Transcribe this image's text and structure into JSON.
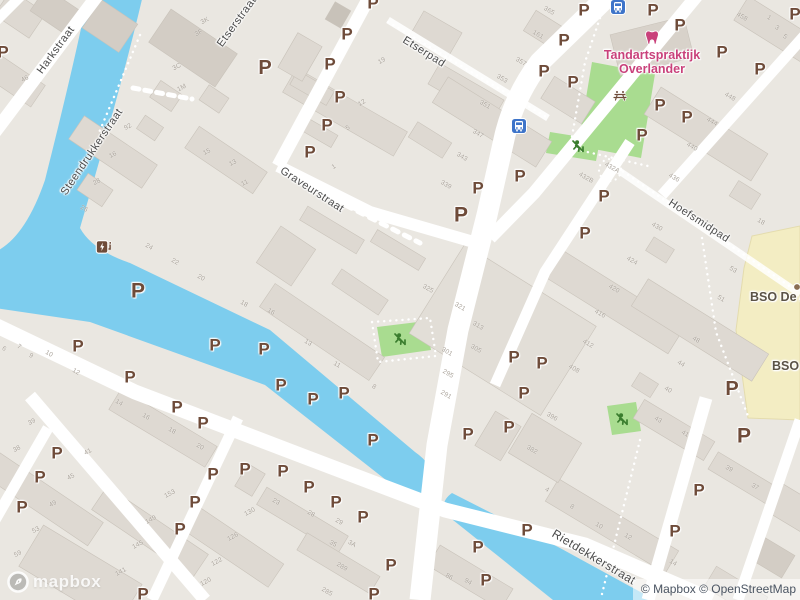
{
  "map": {
    "attribution": "© Mapbox © OpenStreetMap",
    "logo_text": "mapbox",
    "colors": {
      "land": "#eae7e1",
      "water": "#7dcdee",
      "park": "#a9dc90",
      "school_building": "#f3edc3",
      "parking_brown": "#6e4b39",
      "street_label_gray": "#4c4c4c",
      "poi_pink": "#c9417b",
      "poi_school_label": "#5b5346",
      "bus_blue": "#3e74c9",
      "playground_green": "#3a7d2e"
    },
    "street_labels": [
      {
        "text": "Harkstraat",
        "x": 56,
        "y": 50,
        "rot": -54,
        "size": 11
      },
      {
        "text": "Steendrukkerstraat",
        "x": 92,
        "y": 152,
        "rot": -56,
        "size": 11
      },
      {
        "text": "Etserstraat",
        "x": 237,
        "y": 22,
        "rot": -54,
        "size": 11
      },
      {
        "text": "Etserpad",
        "x": 424,
        "y": 52,
        "rot": 32,
        "size": 11
      },
      {
        "text": "Graveurstraat",
        "x": 312,
        "y": 190,
        "rot": 33,
        "size": 11
      },
      {
        "text": "Hoefsmidpad",
        "x": 699,
        "y": 221,
        "rot": 33,
        "size": 11
      },
      {
        "text": "Rietdekkerstraat",
        "x": 594,
        "y": 557,
        "rot": 31,
        "size": 12
      }
    ],
    "poi": {
      "dentist": {
        "line1": "Tandartspraktijk",
        "line2": "Overlander",
        "x": 652,
        "y": 62
      },
      "schools": [
        {
          "label": "BSO De A",
          "x": 750,
          "y": 297
        },
        {
          "label": "BSO H",
          "x": 772,
          "y": 366
        }
      ]
    },
    "parking": {
      "glyph": "P",
      "positions": [
        [
          3,
          52
        ],
        [
          265,
          68,
          20
        ],
        [
          330,
          64
        ],
        [
          347,
          34
        ],
        [
          373,
          3
        ],
        [
          340,
          97
        ],
        [
          327,
          125
        ],
        [
          310,
          152
        ],
        [
          478,
          188
        ],
        [
          520,
          176
        ],
        [
          461,
          215,
          21
        ],
        [
          544,
          71
        ],
        [
          564,
          40
        ],
        [
          584,
          10
        ],
        [
          573,
          82
        ],
        [
          653,
          10
        ],
        [
          680,
          25
        ],
        [
          722,
          52
        ],
        [
          760,
          69
        ],
        [
          795,
          14
        ],
        [
          660,
          105
        ],
        [
          687,
          117
        ],
        [
          642,
          135
        ],
        [
          604,
          196
        ],
        [
          585,
          233
        ],
        [
          542,
          363
        ],
        [
          732,
          389,
          20
        ],
        [
          744,
          436,
          21
        ],
        [
          699,
          490
        ],
        [
          675,
          531
        ],
        [
          138,
          291,
          21
        ],
        [
          215,
          345
        ],
        [
          264,
          349
        ],
        [
          78,
          346
        ],
        [
          130,
          377
        ],
        [
          281,
          385
        ],
        [
          344,
          393
        ],
        [
          514,
          357
        ],
        [
          524,
          393
        ],
        [
          313,
          399
        ],
        [
          177,
          407
        ],
        [
          203,
          423
        ],
        [
          57,
          453
        ],
        [
          40,
          477
        ],
        [
          22,
          507
        ],
        [
          213,
          474
        ],
        [
          245,
          469
        ],
        [
          195,
          502
        ],
        [
          180,
          529
        ],
        [
          143,
          594
        ],
        [
          373,
          440
        ],
        [
          283,
          471
        ],
        [
          309,
          487
        ],
        [
          336,
          502
        ],
        [
          363,
          517
        ],
        [
          391,
          565
        ],
        [
          374,
          594
        ],
        [
          468,
          434
        ],
        [
          509,
          427
        ],
        [
          478,
          547
        ],
        [
          527,
          530
        ],
        [
          486,
          580
        ]
      ]
    },
    "house_numbers": [
      [
        "3K",
        205,
        21,
        -28
      ],
      [
        "3F",
        199,
        33,
        -28
      ],
      [
        "3C",
        177,
        67,
        -28
      ],
      [
        "1M",
        182,
        88,
        -28
      ],
      [
        "46",
        25,
        79,
        -28
      ],
      [
        "92",
        128,
        127,
        -28
      ],
      [
        "16",
        113,
        155,
        -28
      ],
      [
        "28",
        97,
        182,
        -28
      ],
      [
        "15",
        207,
        152,
        -28
      ],
      [
        "13",
        233,
        163,
        -28
      ],
      [
        "11",
        245,
        183,
        -28
      ],
      [
        "19",
        382,
        61,
        -30
      ],
      [
        "12",
        362,
        103,
        -30
      ],
      [
        "5",
        348,
        128,
        -30
      ],
      [
        "1",
        334,
        167,
        -30
      ],
      [
        "357",
        521,
        62,
        30
      ],
      [
        "353",
        502,
        79,
        30
      ],
      [
        "351",
        485,
        105,
        30
      ],
      [
        "347",
        478,
        134,
        30
      ],
      [
        "343",
        462,
        157,
        30
      ],
      [
        "339",
        446,
        185,
        30
      ],
      [
        "365",
        549,
        11,
        30
      ],
      [
        "161",
        538,
        35,
        30
      ],
      [
        "458",
        742,
        17,
        30
      ],
      [
        "1",
        769,
        18,
        30
      ],
      [
        "3",
        777,
        28,
        30
      ],
      [
        "5",
        785,
        37,
        30
      ],
      [
        "448",
        730,
        97,
        30
      ],
      [
        "444",
        712,
        122,
        30
      ],
      [
        "440",
        692,
        147,
        30
      ],
      [
        "436",
        674,
        178,
        30
      ],
      [
        "432A",
        612,
        168,
        30
      ],
      [
        "432B",
        586,
        178,
        30
      ],
      [
        "26",
        84,
        209,
        30
      ],
      [
        "24",
        149,
        247,
        30
      ],
      [
        "22",
        175,
        262,
        30
      ],
      [
        "20",
        201,
        278,
        30
      ],
      [
        "18",
        244,
        304,
        30
      ],
      [
        "6",
        4,
        349,
        30
      ],
      [
        "7",
        19,
        347,
        30
      ],
      [
        "9",
        31,
        356,
        30
      ],
      [
        "10",
        49,
        354,
        30
      ],
      [
        "12",
        76,
        372,
        30
      ],
      [
        "325",
        428,
        289,
        30
      ],
      [
        "321",
        460,
        307,
        30
      ],
      [
        "313",
        478,
        326,
        30
      ],
      [
        "305",
        476,
        349,
        30
      ],
      [
        "301",
        447,
        352,
        30
      ],
      [
        "295",
        448,
        374,
        30
      ],
      [
        "291",
        446,
        395,
        30
      ],
      [
        "16",
        271,
        312,
        30
      ],
      [
        "13",
        308,
        343,
        30
      ],
      [
        "11",
        337,
        365,
        30
      ],
      [
        "8",
        374,
        387,
        30
      ],
      [
        "430",
        657,
        227,
        30
      ],
      [
        "424",
        632,
        261,
        30
      ],
      [
        "420",
        614,
        289,
        30
      ],
      [
        "416",
        600,
        314,
        30
      ],
      [
        "412",
        588,
        344,
        30
      ],
      [
        "408",
        574,
        369,
        30
      ],
      [
        "53",
        733,
        270,
        30
      ],
      [
        "51",
        721,
        299,
        30
      ],
      [
        "48",
        696,
        340,
        30
      ],
      [
        "44",
        681,
        364,
        30
      ],
      [
        "40",
        668,
        390,
        30
      ],
      [
        "18",
        761,
        222,
        30
      ],
      [
        "39",
        32,
        422,
        -28
      ],
      [
        "38",
        17,
        449,
        -28
      ],
      [
        "41",
        88,
        452,
        -28
      ],
      [
        "45",
        71,
        477,
        -28
      ],
      [
        "49",
        53,
        504,
        -28
      ],
      [
        "53",
        36,
        530,
        -28
      ],
      [
        "59",
        18,
        554,
        -28
      ],
      [
        "14",
        119,
        403,
        30
      ],
      [
        "16",
        146,
        417,
        30
      ],
      [
        "18",
        172,
        431,
        30
      ],
      [
        "20",
        200,
        447,
        30
      ],
      [
        "153",
        170,
        494,
        -28
      ],
      [
        "149",
        151,
        520,
        -28
      ],
      [
        "145",
        138,
        545,
        -28
      ],
      [
        "141",
        121,
        572,
        -28
      ],
      [
        "130",
        250,
        512,
        -28
      ],
      [
        "126",
        233,
        537,
        -28
      ],
      [
        "122",
        217,
        562,
        -28
      ],
      [
        "120",
        206,
        582,
        -28
      ],
      [
        "23",
        276,
        502,
        30
      ],
      [
        "28",
        311,
        514,
        30
      ],
      [
        "29",
        339,
        522,
        30
      ],
      [
        "35",
        333,
        544,
        30
      ],
      [
        "3A",
        352,
        544,
        30
      ],
      [
        "289",
        342,
        567,
        30
      ],
      [
        "285",
        327,
        592,
        30
      ],
      [
        "86",
        449,
        577,
        30
      ],
      [
        "94",
        468,
        582,
        30
      ],
      [
        "396",
        552,
        417,
        30
      ],
      [
        "382",
        532,
        450,
        30
      ],
      [
        "4",
        547,
        490,
        30
      ],
      [
        "8",
        572,
        507,
        30
      ],
      [
        "10",
        599,
        526,
        30
      ],
      [
        "12",
        628,
        537,
        30
      ],
      [
        "14",
        673,
        563,
        30
      ],
      [
        "43",
        658,
        420,
        30
      ],
      [
        "41",
        685,
        434,
        30
      ],
      [
        "39",
        729,
        469,
        30
      ],
      [
        "37",
        755,
        487,
        30
      ]
    ],
    "bus_stops": [
      [
        618,
        7
      ],
      [
        519,
        126
      ]
    ],
    "ev_chargers": [
      [
        104,
        247
      ]
    ],
    "dentist_icons": [
      [
        652,
        38
      ]
    ],
    "picnic_icons": [
      [
        620,
        96
      ]
    ],
    "poi_dots": [
      [
        797,
        287
      ]
    ],
    "playground_icons": [
      [
        578,
        146
      ],
      [
        400,
        339
      ],
      [
        622,
        419
      ]
    ]
  }
}
